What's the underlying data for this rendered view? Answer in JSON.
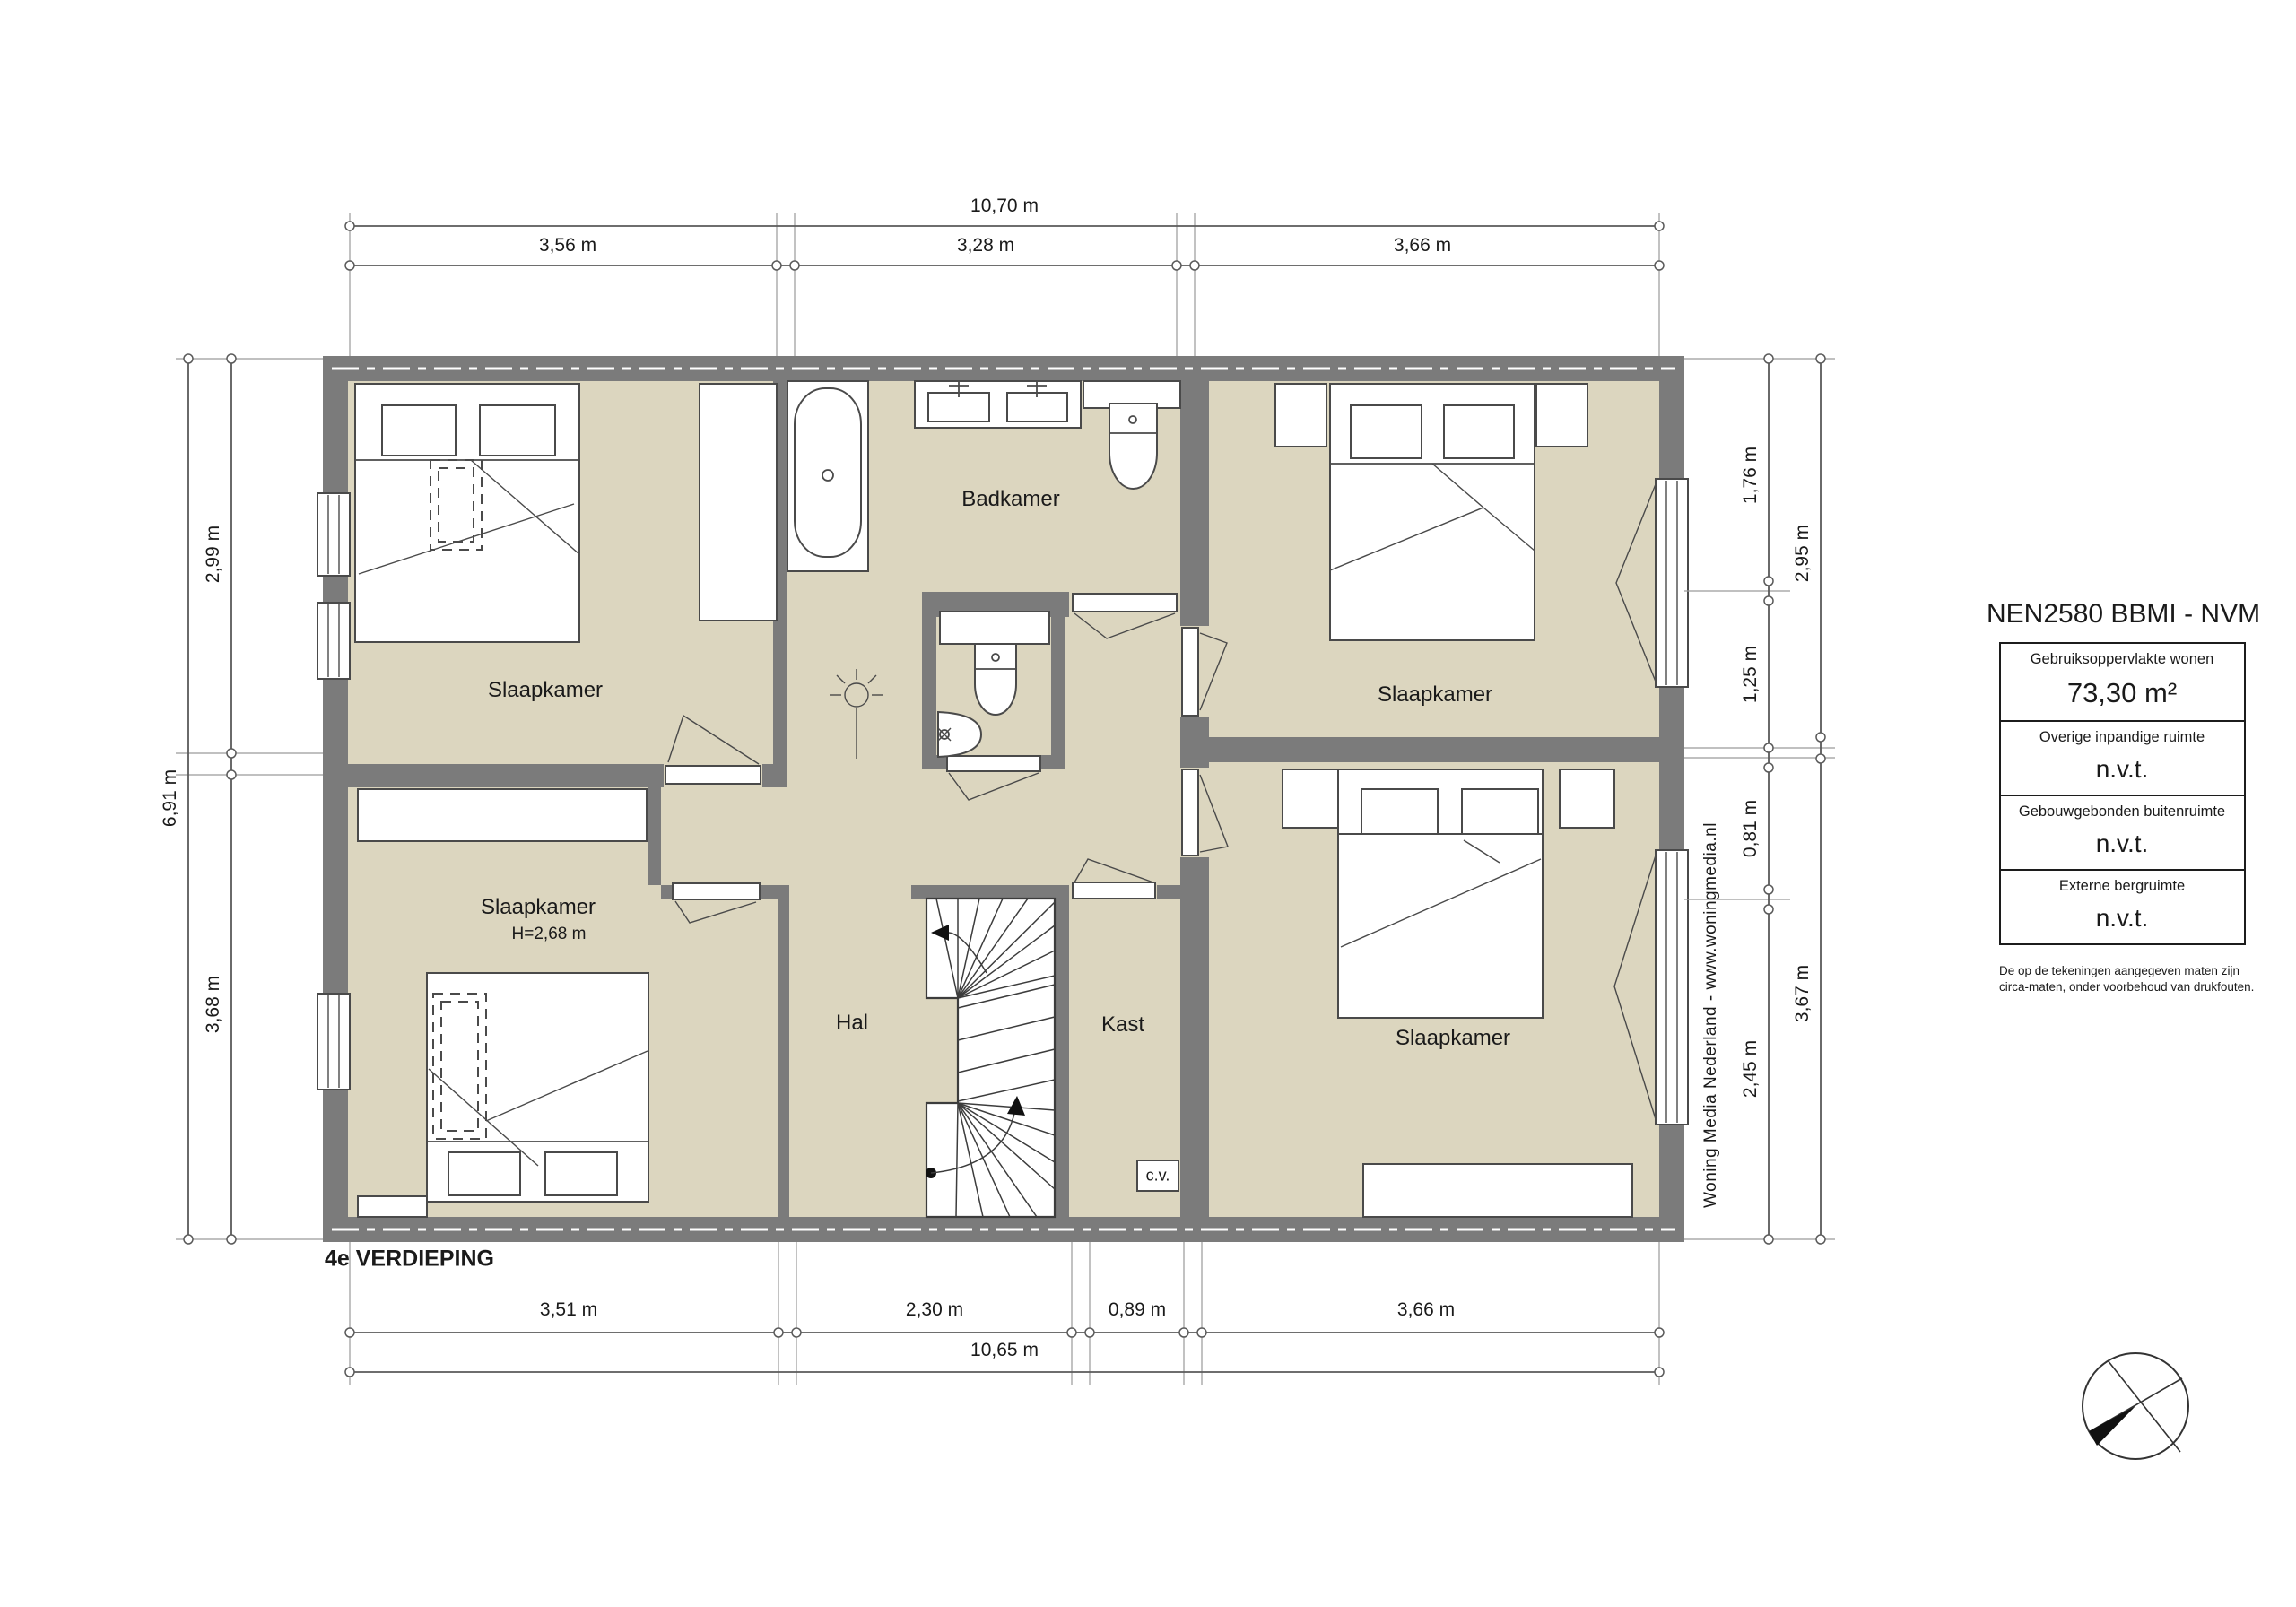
{
  "title": "4e VERDIEPING",
  "rooms": {
    "slaapkamer_tl": "Slaapkamer",
    "slaapkamer_tr": "Slaapkamer",
    "slaapkamer_bl": "Slaapkamer",
    "slaapkamer_bl_height": "H=2,68 m",
    "slaapkamer_br": "Slaapkamer",
    "badkamer": "Badkamer",
    "hal": "Hal",
    "kast": "Kast",
    "cv": "c.v."
  },
  "dimensions": {
    "top": {
      "total": "10,70 m",
      "segments": [
        "3,56 m",
        "3,28 m",
        "3,66 m"
      ]
    },
    "bottom": {
      "total": "10,65 m",
      "segments": [
        "3,51 m",
        "2,30 m",
        "0,89 m",
        "3,66 m"
      ]
    },
    "left": {
      "total": "6,91 m",
      "segments": [
        "2,99 m",
        "3,68 m"
      ]
    },
    "right": {
      "inner": [
        "1,76 m",
        "1,25 m",
        "0,81 m",
        "2,45 m"
      ],
      "outer": [
        "2,95 m",
        "3,67 m"
      ]
    }
  },
  "panel": {
    "title": "NEN2580 BBMI - NVM",
    "rows": [
      {
        "label": "Gebruiksoppervlakte wonen",
        "value": "73,30 m²"
      },
      {
        "label": "Overige inpandige ruimte",
        "value": "n.v.t."
      },
      {
        "label": "Gebouwgebonden buitenruimte",
        "value": "n.v.t."
      },
      {
        "label": "Externe bergruimte",
        "value": "n.v.t."
      }
    ],
    "disclaimer_line1": "De op de tekeningen aangegeven maten zijn",
    "disclaimer_line2": "circa-maten, onder voorbehoud van drukfouten."
  },
  "watermark": "Woning Media Nederland - www.woningmedia.nl",
  "colors": {
    "wall": "#7b7b7b",
    "floor": "#dcd6bf",
    "line": "#4a4a4a"
  }
}
